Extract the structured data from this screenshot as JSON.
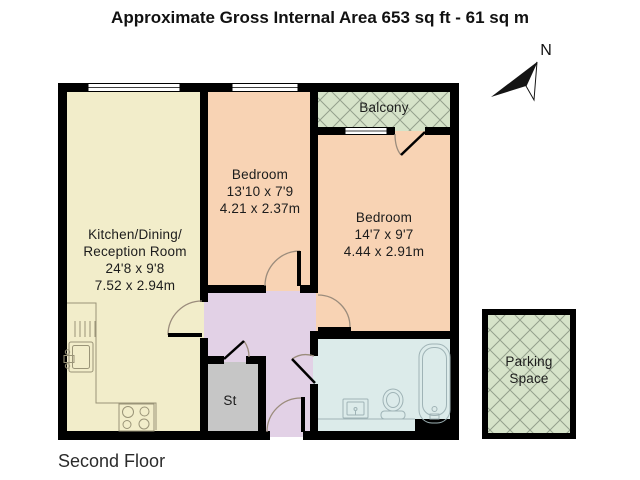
{
  "title": "Approximate Gross Internal Area 653 sq ft - 61 sq m",
  "floor_label": "Second Floor",
  "compass": {
    "north_label": "N"
  },
  "rooms": {
    "kitchen": {
      "name_line1": "Kitchen/Dining/",
      "name_line2": "Reception Room",
      "dims_imperial": "24'8 x 9'8",
      "dims_metric": "7.52 x 2.94m"
    },
    "bedroom_middle": {
      "name": "Bedroom",
      "dims_imperial": "13'10 x 7'9",
      "dims_metric": "4.21 x 2.37m"
    },
    "bedroom_right": {
      "name": "Bedroom",
      "dims_imperial": "14'7 x 9'7",
      "dims_metric": "4.44 x 2.91m"
    },
    "balcony": {
      "name": "Balcony"
    },
    "storage": {
      "name": "St"
    },
    "bathroom": {
      "fixtures": [
        "sink",
        "toilet",
        "bathtub"
      ]
    },
    "parking": {
      "name_line1": "Parking",
      "name_line2": "Space"
    }
  },
  "colors": {
    "wall": "#000000",
    "kitchen_fill": "#f2edca",
    "bedroom_fill": "#f8d3b4",
    "hallway_fill": "#e2d1e6",
    "storage_fill": "#c6c6c6",
    "bathroom_fill": "#dcebea",
    "outdoor_fill": "#d6e3c9",
    "hatch_line": "#93a08c",
    "door_arc": "#9b8c7c"
  }
}
